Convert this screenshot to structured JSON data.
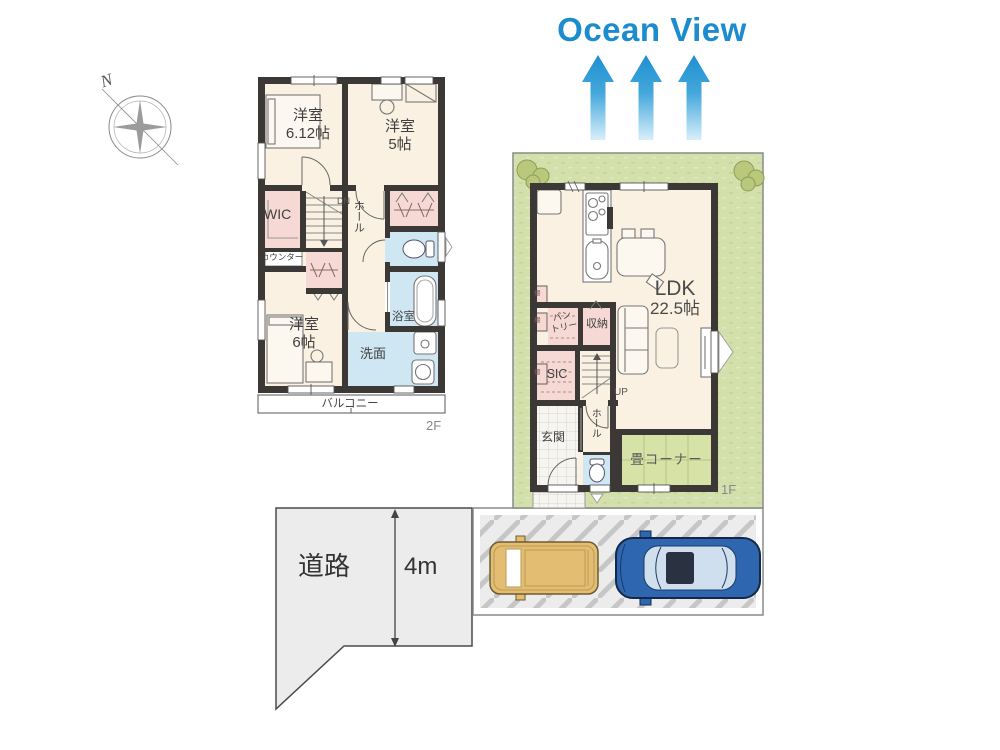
{
  "title": {
    "text": "Ocean View"
  },
  "compass": {
    "north": "N"
  },
  "floor2": {
    "floor_label": "2F",
    "bedroom1": "洋室\n6.12帖",
    "bedroom2": "洋室\n5帖",
    "bedroom3": "洋室\n6帖",
    "wic": "WIC",
    "stairs": "DN",
    "hall": "ホール",
    "counter": "カウンター",
    "bathroom": "浴室",
    "washroom": "洗面",
    "balcony": "バルコニー"
  },
  "floor1": {
    "floor_label": "1F",
    "ldk_name": "LDK",
    "ldk_size": "22.5帖",
    "pantry": "パン\nトリー",
    "storage": "収納",
    "sic": "SIC",
    "stairs": "UP",
    "entrance": "玄関",
    "hall": "ホール",
    "tatami_corner": "畳コーナー",
    "shelf": "棚"
  },
  "site": {
    "road_label": "道路",
    "road_width": "4m"
  },
  "colors": {
    "wall": "#3b3835",
    "room_floor": "#faf1e3",
    "closet_pink": "#f6d9d4",
    "wet_area_blue": "#cfe6f3",
    "lawn_green": "#d3e0ab",
    "tatami_green": "#d6e2a6",
    "road_gray": "#ececec",
    "ocean_blue": "#1b8ccd"
  }
}
